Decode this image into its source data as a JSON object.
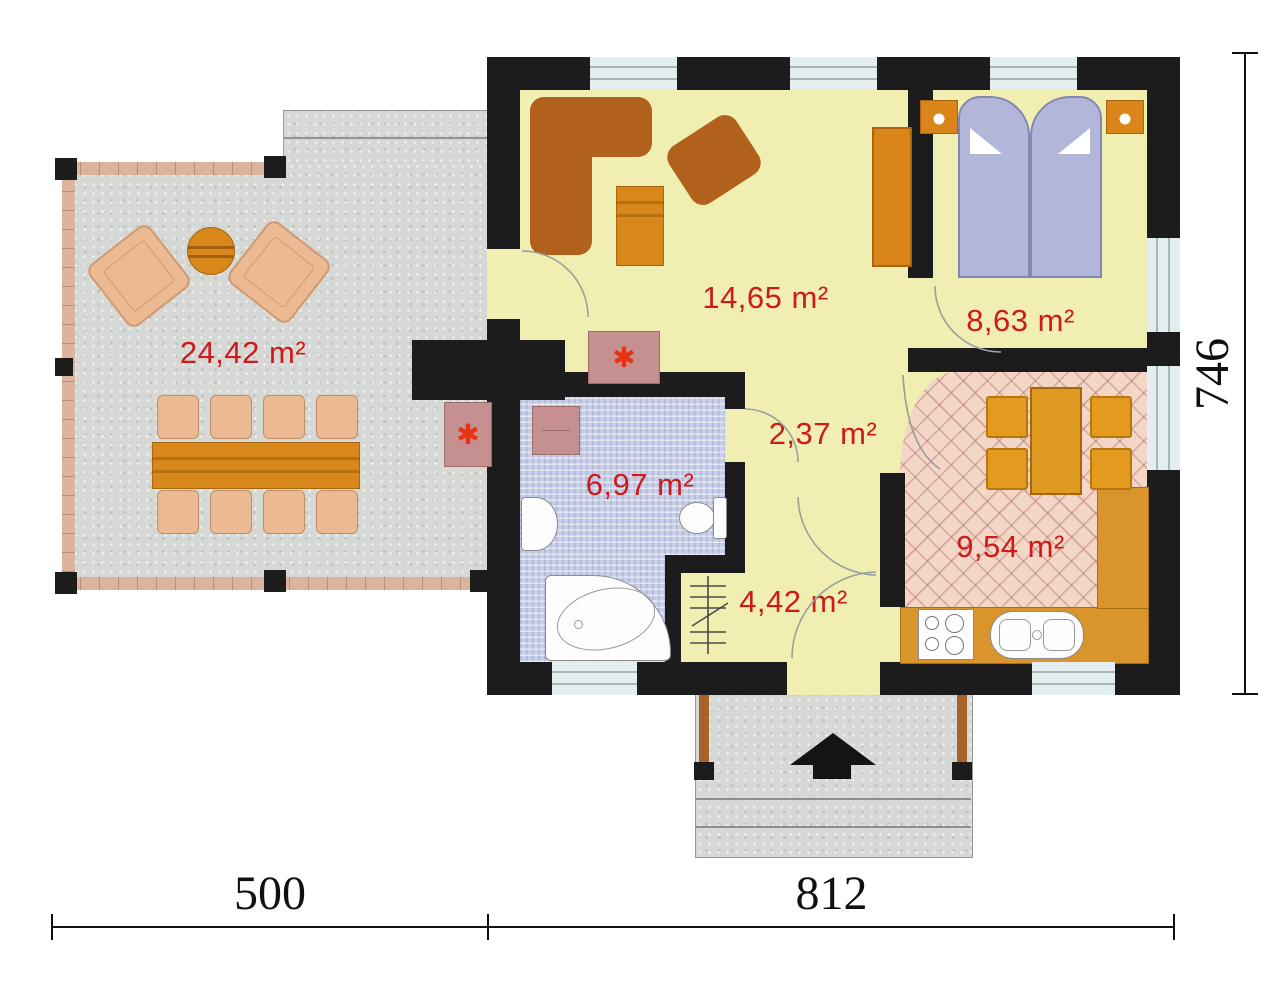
{
  "rooms": {
    "terrace": {
      "area": "24,42 m²"
    },
    "living_room": {
      "area": "14,65 m²"
    },
    "bedroom": {
      "area": "8,63 m²"
    },
    "hall": {
      "area": "2,37 m²"
    },
    "bathroom": {
      "area": "6,97 m²"
    },
    "entry": {
      "area": "4,42 m²"
    },
    "kitchen": {
      "area": "9,54 m²"
    }
  },
  "dimensions": {
    "terrace_width": "500",
    "house_width": "812",
    "house_height": "746"
  },
  "icons": {
    "fireplace": "✱"
  },
  "colors": {
    "wall": "#1c1c1c",
    "floor": "#f0eeb0",
    "kitchen_floor": "#f3d6c6",
    "bathroom_floor": "#c7cee6",
    "terrace_floor": "#d5d8d4",
    "deck_wood": "#dcb49e",
    "wood": "#d8871a",
    "counter": "#d9952b",
    "chair": "#ecba92",
    "upholstery": "#b2611c",
    "bed": "#b2b6d8",
    "window": "#e4edef",
    "accent_pink": "#c79090",
    "asterisk_red": "#e63312",
    "label": "#cd1a1a"
  }
}
